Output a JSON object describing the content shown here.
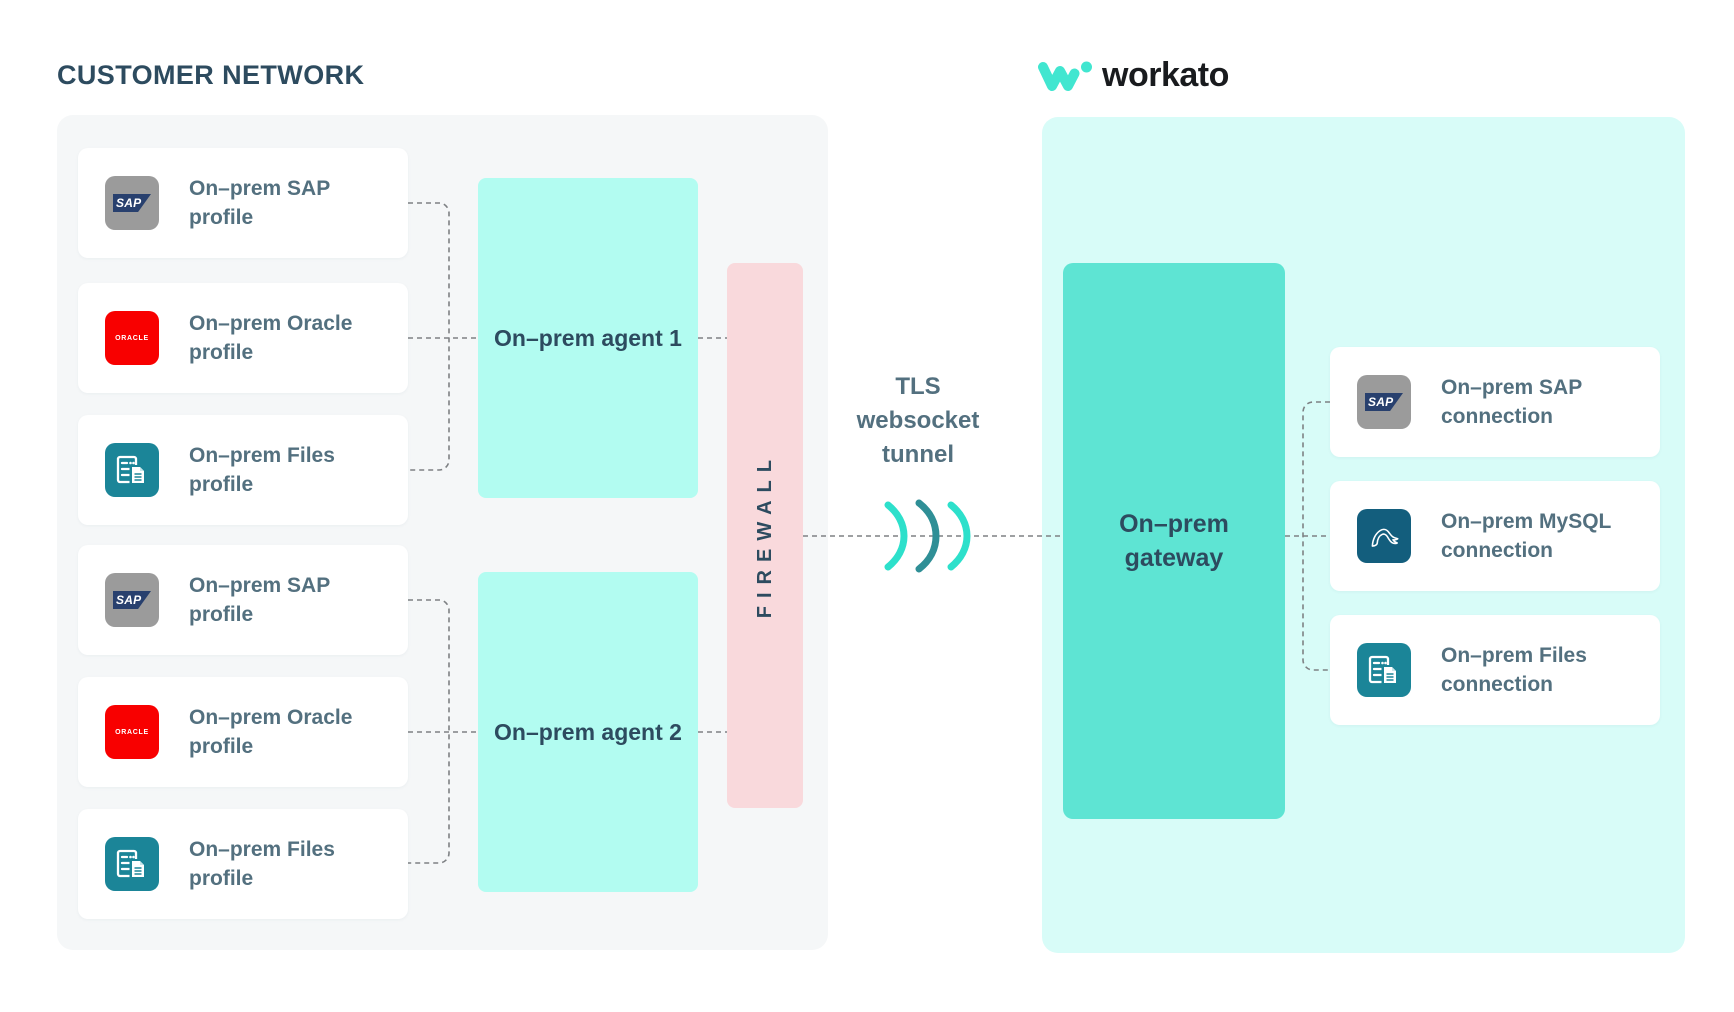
{
  "customer_network": {
    "title": "CUSTOMER NETWORK",
    "profiles": [
      {
        "line1": "On–prem SAP",
        "line2": "profile"
      },
      {
        "line1": "On–prem Oracle",
        "line2": "profile"
      },
      {
        "line1": "On–prem Files",
        "line2": "profile"
      },
      {
        "line1": "On–prem SAP",
        "line2": "profile"
      },
      {
        "line1": "On–prem Oracle",
        "line2": "profile"
      },
      {
        "line1": "On–prem Files",
        "line2": "profile"
      }
    ],
    "agent1_label": "On–prem agent 1",
    "agent2_label": "On–prem agent 2",
    "firewall_label": "FIREWALL"
  },
  "tunnel": {
    "line1": "TLS",
    "line2": "websocket",
    "line3": "tunnel"
  },
  "workato": {
    "logo_text": "workato"
  },
  "workato_panel": {
    "gateway_line1": "On–prem",
    "gateway_line2": "gateway",
    "connections": [
      {
        "line1": "On–prem SAP",
        "line2": "connection"
      },
      {
        "line1": "On–prem MySQL",
        "line2": "connection"
      },
      {
        "line1": "On–prem Files",
        "line2": "connection"
      }
    ]
  },
  "icon_labels": {
    "sap": "SAP",
    "oracle": "ORACLE"
  },
  "colors": {
    "accent_teal": "#2DE0CB",
    "arc_dark_teal": "#2F8F96",
    "dark_slate": "#2D4B5F",
    "card_text": "#53707F",
    "agent_fill": "#B2FCF1",
    "gateway_fill": "#5EE4D3",
    "firewall_fill": "#F9D9DC",
    "left_panel_fill": "#F5F7F8",
    "right_panel_fill": "#D8FCF8",
    "sap_gray": "#9B9B9B",
    "oracle_red": "#F80000",
    "files_teal": "#1B8598",
    "mysql_blue": "#135E7D",
    "workato_mark": "#41E6D0"
  }
}
